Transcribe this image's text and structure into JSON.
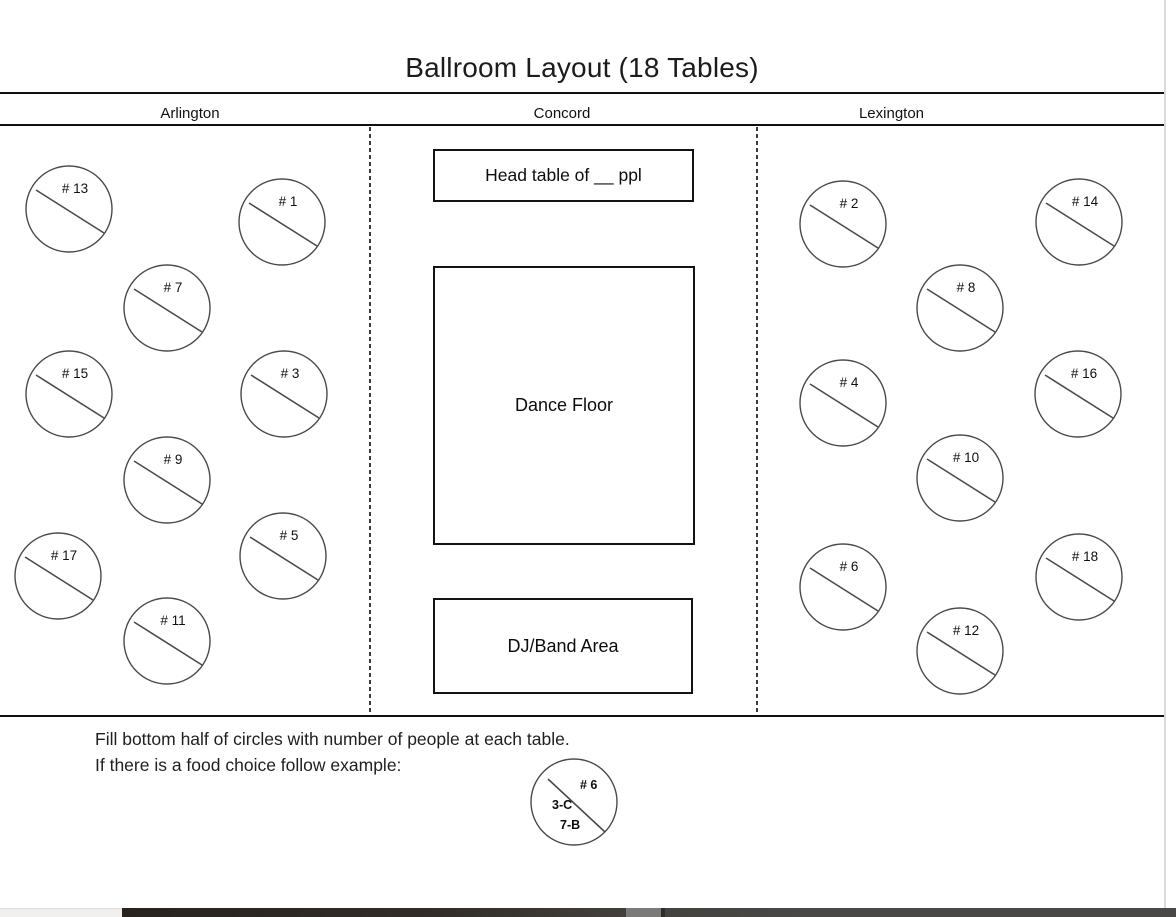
{
  "title": "Ballroom Layout (18 Tables)",
  "sections": [
    {
      "name": "Arlington"
    },
    {
      "name": "Concord"
    },
    {
      "name": "Lexington"
    }
  ],
  "areas": {
    "head_table_label": "Head table of __ ppl",
    "dance_floor_label": "Dance Floor",
    "dj_band_label": "DJ/Band Area"
  },
  "tables": [
    {
      "number": 13,
      "label": "# 13",
      "section": "Arlington",
      "cx": 69,
      "cy": 209
    },
    {
      "number": 1,
      "label": "# 1",
      "section": "Arlington",
      "cx": 282,
      "cy": 222
    },
    {
      "number": 7,
      "label": "# 7",
      "section": "Arlington",
      "cx": 167,
      "cy": 308
    },
    {
      "number": 15,
      "label": "# 15",
      "section": "Arlington",
      "cx": 69,
      "cy": 394
    },
    {
      "number": 3,
      "label": "# 3",
      "section": "Arlington",
      "cx": 284,
      "cy": 394
    },
    {
      "number": 9,
      "label": "# 9",
      "section": "Arlington",
      "cx": 167,
      "cy": 480
    },
    {
      "number": 17,
      "label": "# 17",
      "section": "Arlington",
      "cx": 58,
      "cy": 576
    },
    {
      "number": 5,
      "label": "# 5",
      "section": "Arlington",
      "cx": 283,
      "cy": 556
    },
    {
      "number": 11,
      "label": "# 11",
      "section": "Arlington",
      "cx": 167,
      "cy": 641
    },
    {
      "number": 2,
      "label": "# 2",
      "section": "Lexington",
      "cx": 843,
      "cy": 224
    },
    {
      "number": 14,
      "label": "# 14",
      "section": "Lexington",
      "cx": 1079,
      "cy": 222
    },
    {
      "number": 8,
      "label": "# 8",
      "section": "Lexington",
      "cx": 960,
      "cy": 308
    },
    {
      "number": 4,
      "label": "# 4",
      "section": "Lexington",
      "cx": 843,
      "cy": 403
    },
    {
      "number": 16,
      "label": "# 16",
      "section": "Lexington",
      "cx": 1078,
      "cy": 394
    },
    {
      "number": 10,
      "label": "# 10",
      "section": "Lexington",
      "cx": 960,
      "cy": 478
    },
    {
      "number": 6,
      "label": "# 6",
      "section": "Lexington",
      "cx": 843,
      "cy": 587
    },
    {
      "number": 18,
      "label": "# 18",
      "section": "Lexington",
      "cx": 1079,
      "cy": 577
    },
    {
      "number": 12,
      "label": "# 12",
      "section": "Lexington",
      "cx": 960,
      "cy": 651
    }
  ],
  "instructions": {
    "line1": "Fill bottom half of circles with number of people at each table.",
    "line2": "If there is a food choice follow example:"
  },
  "example_table": {
    "label": "# 6",
    "food_choice_1": "3-C",
    "food_choice_2": "7-B",
    "cx": 574,
    "cy": 802
  },
  "colors": {
    "line_black": "#101010",
    "circle_stroke": "#4a4a4a",
    "page_edge_gray": "#d9d9d9",
    "bar_dark": "#292320",
    "bar_gray": "#4a4846",
    "bar_thumb": "#7b7a78",
    "bar_light": "#f1f0ef"
  }
}
